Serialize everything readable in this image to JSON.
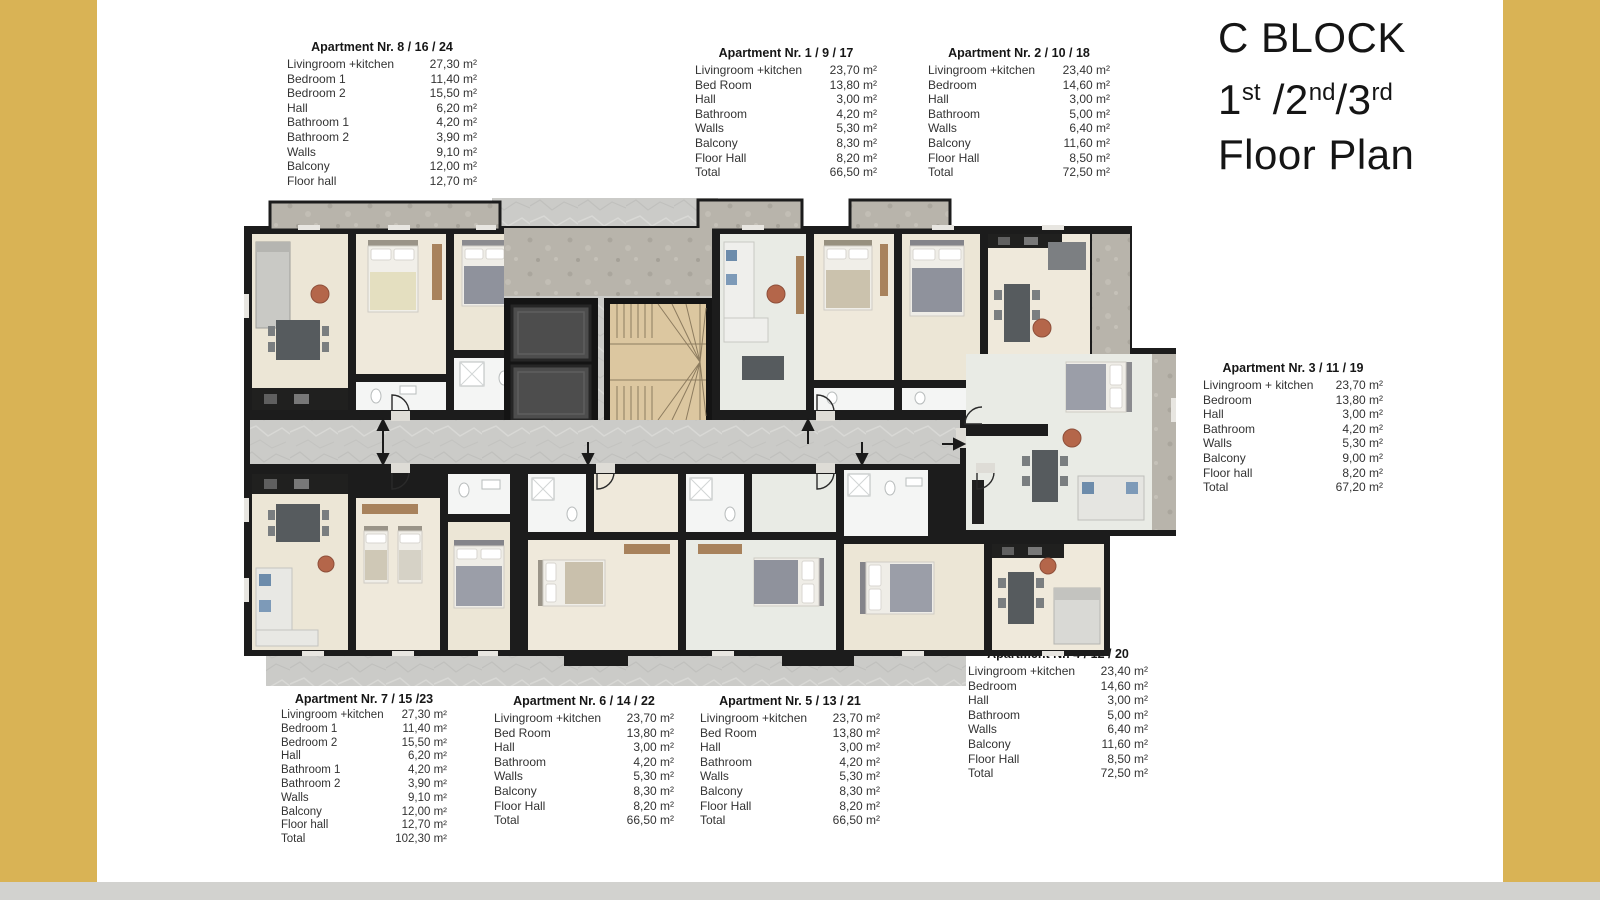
{
  "colors": {
    "accent_bar": "#D9B355",
    "bottom_bar": "#D2D2CF",
    "wall": "#1C1C1C",
    "room_cream": "#ECE6D6",
    "room_light": "#E9EBE5",
    "corridor_gray": "#CBCBC8",
    "concrete": "#B8B4AB",
    "stairs_wood": "#DCC7A0",
    "elevator_cab": "#4D4D4D"
  },
  "header": {
    "block": "C BLOCK",
    "floors": [
      {
        "t": "1"
      },
      {
        "t": "st",
        "sup": true
      },
      {
        "t": " /2"
      },
      {
        "t": "nd",
        "sup": true
      },
      {
        "t": "/3"
      },
      {
        "t": "rd",
        "sup": true
      }
    ],
    "subtitle": "Floor Plan"
  },
  "unit": "m²",
  "apartments": [
    {
      "id": "8-16-24",
      "title": "Apartment Nr. 8 / 16 / 24",
      "rows": [
        {
          "label": "Livingroom +kitchen",
          "value": "27,30 m²"
        },
        {
          "label": "Bedroom 1",
          "value": "11,40 m²"
        },
        {
          "label": "Bedroom 2",
          "value": "15,50 m²"
        },
        {
          "label": "Hall",
          "value": "6,20 m²"
        },
        {
          "label": "Bathroom 1",
          "value": "4,20 m²"
        },
        {
          "label": "Bathroom 2",
          "value": "3,90 m²"
        },
        {
          "label": "Walls",
          "value": "9,10 m²"
        },
        {
          "label": "Balcony",
          "value": "12,00 m²"
        },
        {
          "label": "Floor hall",
          "value": "12,70 m²"
        }
      ]
    },
    {
      "id": "1-9-17",
      "title": "Apartment Nr. 1 / 9 / 17",
      "rows": [
        {
          "label": "Livingroom +kitchen",
          "value": "23,70 m²"
        },
        {
          "label": "Bed Room",
          "value": "13,80 m²"
        },
        {
          "label": "Hall",
          "value": "3,00 m²"
        },
        {
          "label": "Bathroom",
          "value": "4,20 m²"
        },
        {
          "label": "Walls",
          "value": "5,30 m²"
        },
        {
          "label": "Balcony",
          "value": "8,30 m²"
        },
        {
          "label": "Floor Hall",
          "value": "8,20 m²"
        },
        {
          "label": "Total",
          "value": "66,50 m²"
        }
      ]
    },
    {
      "id": "2-10-18",
      "title": "Apartment Nr. 2 / 10 / 18",
      "rows": [
        {
          "label": "Livingroom +kitchen",
          "value": "23,40 m²"
        },
        {
          "label": "Bedroom",
          "value": "14,60 m²"
        },
        {
          "label": "Hall",
          "value": "3,00 m²"
        },
        {
          "label": "Bathroom",
          "value": "5,00 m²"
        },
        {
          "label": "Walls",
          "value": "6,40 m²"
        },
        {
          "label": "Balcony",
          "value": "11,60 m²"
        },
        {
          "label": "Floor Hall",
          "value": "8,50 m²"
        },
        {
          "label": "Total",
          "value": "72,50 m²"
        }
      ]
    },
    {
      "id": "3-11-19",
      "title": "Apartment Nr. 3 / 11 / 19",
      "rows": [
        {
          "label": "Livingroom + kitchen",
          "value": "23,70 m²"
        },
        {
          "label": "Bedroom",
          "value": "13,80 m²"
        },
        {
          "label": "Hall",
          "value": "3,00 m²"
        },
        {
          "label": "Bathroom",
          "value": "4,20 m²"
        },
        {
          "label": "Walls",
          "value": "5,30 m²"
        },
        {
          "label": "Balcony",
          "value": "9,00 m²"
        },
        {
          "label": "Floor hall",
          "value": "8,20 m²"
        },
        {
          "label": "Total",
          "value": "67,20 m²"
        }
      ]
    },
    {
      "id": "4-12-20",
      "title": "Apartment Nr. 4 / 12 / 20",
      "rows": [
        {
          "label": "Livingroom +kitchen",
          "value": "23,40 m²"
        },
        {
          "label": "Bedroom",
          "value": "14,60 m²"
        },
        {
          "label": "Hall",
          "value": "3,00 m²"
        },
        {
          "label": "Bathroom",
          "value": "5,00 m²"
        },
        {
          "label": "Walls",
          "value": "6,40 m²"
        },
        {
          "label": "Balcony",
          "value": "11,60 m²"
        },
        {
          "label": "Floor Hall",
          "value": "8,50 m²"
        },
        {
          "label": "Total",
          "value": "72,50 m²"
        }
      ]
    },
    {
      "id": "5-13-21",
      "title": "Apartment Nr. 5 / 13 / 21",
      "rows": [
        {
          "label": "Livingroom +kitchen",
          "value": "23,70 m²"
        },
        {
          "label": "Bed Room",
          "value": "13,80 m²"
        },
        {
          "label": "Hall",
          "value": "3,00 m²"
        },
        {
          "label": "Bathroom",
          "value": "4,20 m²"
        },
        {
          "label": "Walls",
          "value": "5,30 m²"
        },
        {
          "label": "Balcony",
          "value": "8,30 m²"
        },
        {
          "label": "Floor Hall",
          "value": "8,20 m²"
        },
        {
          "label": "Total",
          "value": "66,50 m²"
        }
      ]
    },
    {
      "id": "6-14-22",
      "title": "Apartment Nr. 6 / 14 / 22",
      "rows": [
        {
          "label": "Livingroom +kitchen",
          "value": "23,70 m²"
        },
        {
          "label": "Bed Room",
          "value": "13,80 m²"
        },
        {
          "label": "Hall",
          "value": "3,00 m²"
        },
        {
          "label": "Bathroom",
          "value": "4,20 m²"
        },
        {
          "label": "Walls",
          "value": "5,30 m²"
        },
        {
          "label": "Balcony",
          "value": "8,30 m²"
        },
        {
          "label": "Floor Hall",
          "value": "8,20 m²"
        },
        {
          "label": "Total",
          "value": "66,50 m²"
        }
      ]
    },
    {
      "id": "7-15-23",
      "title": "Apartment Nr. 7 / 15 /23",
      "rows": [
        {
          "label": "Livingroom +kitchen",
          "value": "27,30 m²"
        },
        {
          "label": "Bedroom 1",
          "value": "11,40 m²"
        },
        {
          "label": "Bedroom 2",
          "value": "15,50 m²"
        },
        {
          "label": "Hall",
          "value": "6,20 m²"
        },
        {
          "label": "Bathroom 1",
          "value": "4,20 m²"
        },
        {
          "label": "Bathroom 2",
          "value": "3,90 m²"
        },
        {
          "label": "Walls",
          "value": "9,10 m²"
        },
        {
          "label": "Balcony",
          "value": "12,00 m²"
        },
        {
          "label": "Floor hall",
          "value": "12,70 m²"
        },
        {
          "label": "Total",
          "value": "102,30 m²"
        }
      ]
    }
  ]
}
